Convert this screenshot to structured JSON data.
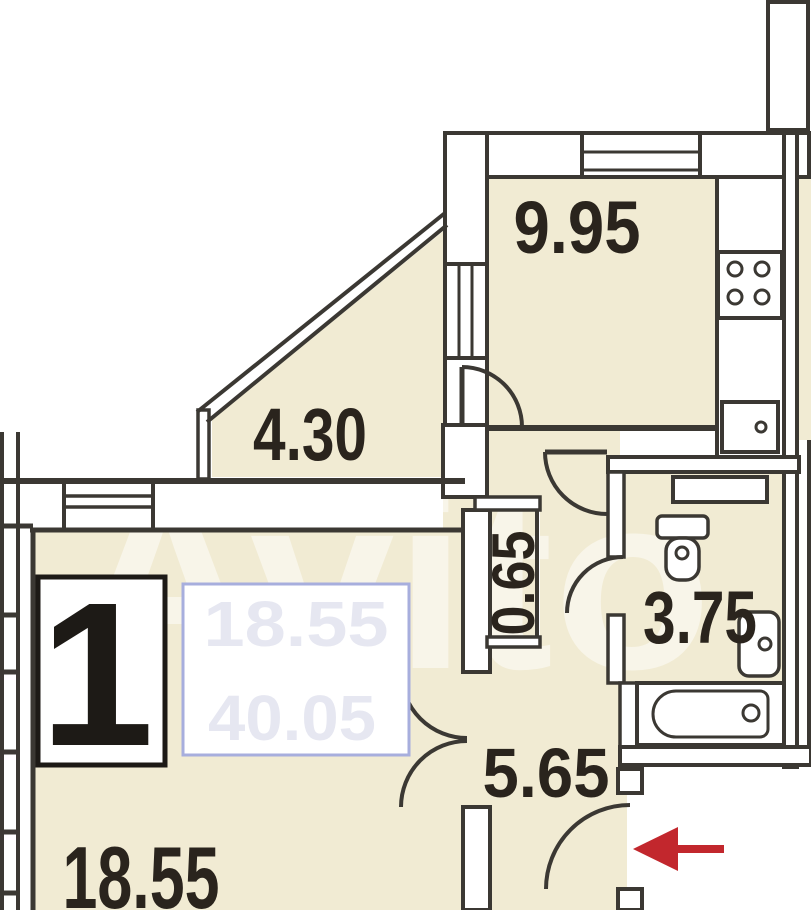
{
  "watermark": {
    "text": "Avito"
  },
  "unit": {
    "number": "1"
  },
  "rooms": {
    "kitchen": {
      "area": "9.95"
    },
    "balcony": {
      "area": "4.30"
    },
    "duct": {
      "area": "0.65"
    },
    "bathroom": {
      "area": "3.75"
    },
    "hallway": {
      "area": "5.65"
    },
    "living_room": {
      "area": "18.55"
    }
  },
  "privacy_cover": {
    "faint_value_top": "18.55",
    "faint_value_bottom": "40.05"
  },
  "colors": {
    "room_fill": "#f1ebd3",
    "wall_line": "#3b3833",
    "entrance_arrow": "#c2272d",
    "cover_border": "#a7aedd",
    "label_text": "#2a241d"
  },
  "fixtures": {
    "stove": "stove-icon",
    "kitchen_sink": "kitchen-sink-icon",
    "toilet": "toilet-icon",
    "washbasin": "washbasin-icon",
    "bathtub": "bathtub-icon",
    "vent_duct": "vent-duct-box",
    "entrance_arrow": "entrance-arrow-icon"
  }
}
